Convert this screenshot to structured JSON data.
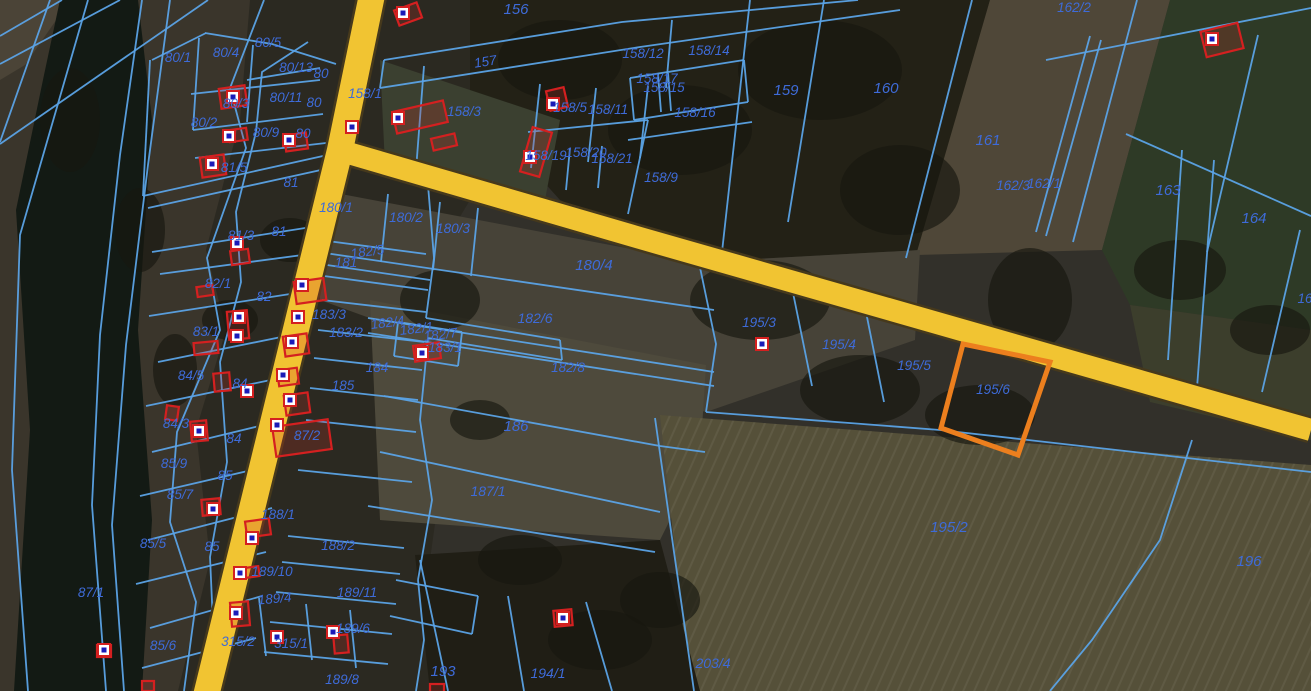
{
  "map": {
    "title": "cadastral-aerial-map",
    "colors": {
      "boundary_line": "#5BA3E6",
      "label_text": "#3E6BD8",
      "building_outline": "#D42020",
      "building_fill": "rgba(205,50,40,0.22)",
      "marker_fill": "#FFFFFF",
      "marker_dot": "#1A1AB8",
      "road_fill": "#F1C432",
      "road_casing": "#46391C",
      "highlight": "#EC7F1E",
      "river": "#131A14"
    },
    "terrain": {
      "base": "#32302a",
      "polygons": [
        {
          "points": "0,0 260,0 245,691 0,691",
          "fill": "#3a352b"
        },
        {
          "points": "0,0 70,0 25,65 0,80",
          "fill": "#4b4437"
        },
        {
          "points": "60,0 138,0 152,120 138,330 152,520 142,691 14,691 30,430 16,210 44,75",
          "fill": "#131a14"
        },
        {
          "points": "250,0 470,0 470,200 440,250 452,400 430,560 442,691 178,691 210,560 196,430 226,330 206,250 240,120",
          "fill": "#2b2921"
        },
        {
          "points": "470,0 990,0 920,250 700,262 560,200 470,100",
          "fill": "#232116"
        },
        {
          "points": "380,60 560,120 545,200 385,165",
          "fill": "#3b4030"
        },
        {
          "points": "990,0 1170,0 1102,250 916,255",
          "fill": "#4f4738"
        },
        {
          "points": "1170,0 1311,0 1311,330 1130,305 1102,250",
          "fill": "#2e3a26"
        },
        {
          "points": "1130,305 1311,330 1311,440 1150,402",
          "fill": "#3c3e2c"
        },
        {
          "points": "320,190 700,262 920,250 915,340 706,412 430,340 320,300",
          "fill": "#474338"
        },
        {
          "points": "370,300 706,365 700,460 660,540 380,520",
          "fill": "#4e4a3c"
        },
        {
          "points": "660,415 1311,465 1311,691 690,691",
          "fill": "#555039"
        },
        {
          "points": "660,415 1311,465 1311,691 690,691",
          "fill": "url(#rowstripes)"
        },
        {
          "points": "415,555 660,540 700,691 430,691",
          "fill": "#201e15"
        }
      ],
      "tree_blobs": [
        [
          560,
          60,
          62,
          40
        ],
        [
          680,
          130,
          72,
          45
        ],
        [
          820,
          70,
          82,
          50
        ],
        [
          900,
          190,
          60,
          45
        ],
        [
          760,
          300,
          70,
          40
        ],
        [
          860,
          390,
          60,
          35
        ],
        [
          980,
          415,
          55,
          30
        ],
        [
          1030,
          300,
          42,
          52
        ],
        [
          440,
          300,
          40,
          30
        ],
        [
          480,
          420,
          30,
          20
        ],
        [
          520,
          560,
          42,
          25
        ],
        [
          600,
          640,
          52,
          30
        ],
        [
          660,
          600,
          40,
          28
        ],
        [
          290,
          240,
          30,
          22
        ],
        [
          230,
          320,
          28,
          20
        ],
        [
          1180,
          270,
          46,
          30
        ],
        [
          1270,
          330,
          40,
          25
        ],
        [
          140,
          230,
          25,
          42
        ],
        [
          175,
          370,
          22,
          36
        ],
        [
          70,
          120,
          30,
          52
        ]
      ]
    },
    "roads": [
      {
        "name": "main-road",
        "points": "373,-10 340,150 205,700",
        "width": 26
      },
      {
        "name": "branch-road",
        "points": "338,150 640,238 1311,430",
        "width": 22
      }
    ],
    "boundaries": [
      "50,0 0,142",
      "88,0 20,235 12,470 28,691",
      "142,0 120,155 100,335 92,505 106,691",
      "170,0 148,165 126,345 112,525 124,691",
      "0,64 120,0",
      "0,144 208,0",
      "0,36 62,0",
      "264,0 230,88 246,148 207,258 220,330 177,432 170,522 196,602 184,691",
      "308,42 262,72 256,132 236,212 241,282 220,362 227,462 210,557 216,691",
      "150,60 143,196",
      "143,196 332,154",
      "205,33 272,44 336,64",
      "152,60 206,33",
      "199,38 193,130",
      "253,45 247,122",
      "191,94 320,80",
      "193,130 323,114",
      "195,158 326,143",
      "247,80 320,68",
      "148,208 330,168",
      "152,252 318,226",
      "160,274 310,254",
      "149,316 303,292",
      "158,362 296,334",
      "146,406 290,376",
      "152,452 284,420",
      "140,496 278,464",
      "148,540 272,508",
      "136,584 266,552",
      "150,628 262,596",
      "142,668 256,638",
      "428,185 434,258 426,318",
      "426,318 560,340",
      "560,340 562,360",
      "562,360 428,338",
      "428,338 420,420 432,500 418,580",
      "418,580 424,640 416,691",
      "320,240 426,254",
      "324,276 428,290",
      "322,300 426,312",
      "318,330 424,342",
      "314,358 422,370",
      "310,388 418,400",
      "306,420 416,432",
      "298,470 412,482",
      "288,536 404,548",
      "282,562 400,574",
      "276,592 396,604",
      "270,622 392,634",
      "264,652 388,664",
      "259,598 266,656",
      "306,604 312,660",
      "350,610 356,668",
      "396,580 478,596",
      "390,616 472,634",
      "478,596 472,634",
      "420,560 448,691",
      "508,596 524,691",
      "586,602 612,691",
      "655,418 674,552 694,691",
      "318,252 714,310",
      "320,264 430,280",
      "388,194 381,262",
      "440,202 433,270",
      "478,208 471,276",
      "368,318 714,372",
      "368,333 714,386",
      "398,322 462,332",
      "398,322 394,356",
      "394,356 458,366",
      "462,332 458,366",
      "384,396 660,446 705,452",
      "380,452 660,512",
      "368,506 655,552",
      "697,253 716,344 706,412",
      "790,278 812,386",
      "864,302 884,402",
      "950,320 965,344",
      "1040,346 1051,363",
      "706,412 940,430 1311,472",
      "1192,440 1160,540 1092,640 1050,691",
      "1182,150 1168,360",
      "1214,160 1197,388",
      "1300,230 1262,392",
      "1137,0 1073,242",
      "1258,35 1207,252",
      "1126,134 1311,216",
      "1046,60 1311,8",
      "1090,36 1036,232",
      "1101,40 1046,236",
      "972,0 906,258",
      "824,0 788,222",
      "750,0 722,252",
      "384,60 622,22 858,0",
      "380,88 640,47 900,10",
      "384,60 380,88",
      "672,20 666,88",
      "630,78 744,60",
      "634,120 748,102",
      "630,78 634,120",
      "744,60 748,102",
      "658,74 661,112",
      "668,73 671,111",
      "628,140 752,122",
      "424,66 416,170",
      "540,84 531,168",
      "596,88 588,162",
      "648,86 640,158",
      "528,132 648,120",
      "570,148 566,190",
      "602,146 598,188",
      "648,120 628,214"
    ],
    "highlight_parcel": {
      "label": "195/6",
      "points": "963,344 1050,362 1018,455 941,428"
    },
    "buildings": [
      [
        233,
        97,
        26,
        20,
        -8
      ],
      [
        238,
        135,
        18,
        12,
        -8
      ],
      [
        296,
        142,
        22,
        16,
        -8
      ],
      [
        408,
        14,
        24,
        16,
        -20
      ],
      [
        420,
        117,
        52,
        22,
        -13
      ],
      [
        444,
        142,
        24,
        12,
        -13
      ],
      [
        557,
        99,
        18,
        20,
        -13
      ],
      [
        536,
        152,
        20,
        46,
        16
      ],
      [
        1222,
        40,
        38,
        26,
        -14
      ],
      [
        213,
        166,
        24,
        20,
        -8
      ],
      [
        240,
        257,
        18,
        14,
        -8
      ],
      [
        205,
        291,
        16,
        10,
        -8
      ],
      [
        238,
        325,
        20,
        28,
        -5
      ],
      [
        206,
        348,
        24,
        12,
        -5
      ],
      [
        222,
        382,
        16,
        18,
        -5
      ],
      [
        172,
        413,
        12,
        14,
        8
      ],
      [
        199,
        431,
        16,
        20,
        -5
      ],
      [
        211,
        507,
        18,
        16,
        -5
      ],
      [
        148,
        686,
        12,
        10,
        0
      ],
      [
        104,
        651,
        14,
        12,
        0
      ],
      [
        310,
        291,
        30,
        22,
        -8
      ],
      [
        296,
        345,
        24,
        20,
        -8
      ],
      [
        288,
        377,
        20,
        16,
        -8
      ],
      [
        297,
        404,
        24,
        20,
        -8
      ],
      [
        302,
        438,
        56,
        30,
        -8
      ],
      [
        258,
        528,
        24,
        16,
        -8
      ],
      [
        252,
        572,
        14,
        10,
        -8
      ],
      [
        240,
        614,
        18,
        24,
        -5
      ],
      [
        341,
        644,
        14,
        18,
        -5
      ],
      [
        563,
        618,
        18,
        16,
        -5
      ],
      [
        427,
        352,
        26,
        16,
        -8
      ],
      [
        437,
        688,
        14,
        8,
        0
      ]
    ],
    "markers": [
      [
        233,
        97
      ],
      [
        229,
        136
      ],
      [
        289,
        140
      ],
      [
        352,
        127
      ],
      [
        403,
        13
      ],
      [
        398,
        118
      ],
      [
        553,
        104
      ],
      [
        530,
        157
      ],
      [
        1212,
        39
      ],
      [
        212,
        164
      ],
      [
        237,
        243
      ],
      [
        239,
        317
      ],
      [
        237,
        336
      ],
      [
        302,
        285
      ],
      [
        298,
        317
      ],
      [
        292,
        342
      ],
      [
        283,
        375
      ],
      [
        290,
        400
      ],
      [
        277,
        425
      ],
      [
        247,
        391
      ],
      [
        199,
        431
      ],
      [
        213,
        509
      ],
      [
        104,
        650
      ],
      [
        240,
        573
      ],
      [
        252,
        538
      ],
      [
        236,
        613
      ],
      [
        277,
        637
      ],
      [
        333,
        632
      ],
      [
        563,
        618
      ],
      [
        422,
        353
      ],
      [
        762,
        344
      ]
    ],
    "labels": [
      {
        "t": "156",
        "x": 516,
        "y": 14,
        "s": 15
      },
      {
        "t": "157",
        "x": 486,
        "y": 66,
        "r": -9
      },
      {
        "t": "158/1",
        "x": 365,
        "y": 98
      },
      {
        "t": "158/3",
        "x": 464,
        "y": 116
      },
      {
        "t": "158/5",
        "x": 570,
        "y": 112
      },
      {
        "t": "158/11",
        "x": 608,
        "y": 114
      },
      {
        "t": "158/12",
        "x": 643,
        "y": 58
      },
      {
        "t": "158/14",
        "x": 709,
        "y": 55
      },
      {
        "t": "158/17",
        "x": 657,
        "y": 83
      },
      {
        "t": "158/15",
        "x": 664,
        "y": 92
      },
      {
        "t": "158/16",
        "x": 695,
        "y": 117
      },
      {
        "t": "158/19",
        "x": 546,
        "y": 160
      },
      {
        "t": "158/20",
        "x": 586,
        "y": 157
      },
      {
        "t": "158/21",
        "x": 612,
        "y": 163
      },
      {
        "t": "158/9",
        "x": 661,
        "y": 182
      },
      {
        "t": "159",
        "x": 786,
        "y": 95,
        "s": 15
      },
      {
        "t": "160",
        "x": 886,
        "y": 93,
        "s": 15
      },
      {
        "t": "161",
        "x": 988,
        "y": 145,
        "s": 15
      },
      {
        "t": "162/3",
        "x": 1013,
        "y": 190
      },
      {
        "t": "162/1",
        "x": 1044,
        "y": 188
      },
      {
        "t": "162/2",
        "x": 1074,
        "y": 12
      },
      {
        "t": "163",
        "x": 1168,
        "y": 195,
        "s": 15
      },
      {
        "t": "164",
        "x": 1254,
        "y": 223,
        "s": 15
      },
      {
        "t": "16",
        "x": 1305,
        "y": 303
      },
      {
        "t": "80/1",
        "x": 178,
        "y": 62
      },
      {
        "t": "80/4",
        "x": 226,
        "y": 57
      },
      {
        "t": "80/5",
        "x": 268,
        "y": 47
      },
      {
        "t": "80/13",
        "x": 296,
        "y": 72
      },
      {
        "t": "80",
        "x": 321,
        "y": 78
      },
      {
        "t": "80/3",
        "x": 236,
        "y": 108
      },
      {
        "t": "80/11",
        "x": 286,
        "y": 102
      },
      {
        "t": "80",
        "x": 314,
        "y": 107
      },
      {
        "t": "80/2",
        "x": 204,
        "y": 127
      },
      {
        "t": "80/9",
        "x": 266,
        "y": 137
      },
      {
        "t": "80",
        "x": 303,
        "y": 138
      },
      {
        "t": "81/5",
        "x": 234,
        "y": 172
      },
      {
        "t": "81",
        "x": 291,
        "y": 187
      },
      {
        "t": "81/3",
        "x": 241,
        "y": 240
      },
      {
        "t": "81",
        "x": 279,
        "y": 236
      },
      {
        "t": "82/1",
        "x": 218,
        "y": 288
      },
      {
        "t": "82",
        "x": 264,
        "y": 301
      },
      {
        "t": "83/1",
        "x": 206,
        "y": 336
      },
      {
        "t": "84/5",
        "x": 191,
        "y": 380
      },
      {
        "t": "84",
        "x": 240,
        "y": 388
      },
      {
        "t": "84/3",
        "x": 176,
        "y": 428
      },
      {
        "t": "84",
        "x": 234,
        "y": 443
      },
      {
        "t": "85/9",
        "x": 174,
        "y": 468
      },
      {
        "t": "85",
        "x": 225,
        "y": 480
      },
      {
        "t": "85/7",
        "x": 180,
        "y": 499
      },
      {
        "t": "85/5",
        "x": 153,
        "y": 548
      },
      {
        "t": "85",
        "x": 212,
        "y": 551
      },
      {
        "t": "87/1",
        "x": 91,
        "y": 597
      },
      {
        "t": "85/6",
        "x": 163,
        "y": 650
      },
      {
        "t": "180/1",
        "x": 336,
        "y": 212
      },
      {
        "t": "180/2",
        "x": 406,
        "y": 222
      },
      {
        "t": "180/3",
        "x": 453,
        "y": 233
      },
      {
        "t": "180/4",
        "x": 594,
        "y": 270,
        "s": 15
      },
      {
        "t": "181",
        "x": 346,
        "y": 267
      },
      {
        "t": "182/5",
        "x": 368,
        "y": 256,
        "r": -8
      },
      {
        "t": "183/3",
        "x": 329,
        "y": 319
      },
      {
        "t": "183/2",
        "x": 346,
        "y": 337
      },
      {
        "t": "182/4",
        "x": 388,
        "y": 327,
        "r": -7
      },
      {
        "t": "182/1",
        "x": 417,
        "y": 333,
        "r": -7
      },
      {
        "t": "182/7",
        "x": 441,
        "y": 339,
        "r": -7
      },
      {
        "t": "183/1",
        "x": 445,
        "y": 352
      },
      {
        "t": "182/6",
        "x": 535,
        "y": 323,
        "s": 14
      },
      {
        "t": "182/8",
        "x": 568,
        "y": 372
      },
      {
        "t": "184",
        "x": 377,
        "y": 372
      },
      {
        "t": "185",
        "x": 343,
        "y": 390
      },
      {
        "t": "186",
        "x": 516,
        "y": 431,
        "s": 15
      },
      {
        "t": "187/1",
        "x": 488,
        "y": 496,
        "s": 14
      },
      {
        "t": "87/2",
        "x": 307,
        "y": 440
      },
      {
        "t": "188/1",
        "x": 278,
        "y": 519
      },
      {
        "t": "188/2",
        "x": 338,
        "y": 550
      },
      {
        "t": "189/10",
        "x": 272,
        "y": 576
      },
      {
        "t": "189/4",
        "x": 275,
        "y": 603,
        "r": -5
      },
      {
        "t": "189/11",
        "x": 357,
        "y": 597
      },
      {
        "t": "189/6",
        "x": 353,
        "y": 633
      },
      {
        "t": "315/2",
        "x": 238,
        "y": 646
      },
      {
        "t": "315/1",
        "x": 291,
        "y": 648
      },
      {
        "t": "189/8",
        "x": 342,
        "y": 684
      },
      {
        "t": "195/3",
        "x": 759,
        "y": 327
      },
      {
        "t": "195/4",
        "x": 839,
        "y": 349
      },
      {
        "t": "195/5",
        "x": 914,
        "y": 370
      },
      {
        "t": "195/6",
        "x": 993,
        "y": 394
      },
      {
        "t": "195/2",
        "x": 949,
        "y": 532,
        "s": 15
      },
      {
        "t": "196",
        "x": 1249,
        "y": 566,
        "s": 15
      },
      {
        "t": "203/4",
        "x": 713,
        "y": 668,
        "s": 14
      },
      {
        "t": "193",
        "x": 443,
        "y": 676,
        "s": 15
      },
      {
        "t": "194/1",
        "x": 548,
        "y": 678,
        "s": 14
      }
    ]
  }
}
